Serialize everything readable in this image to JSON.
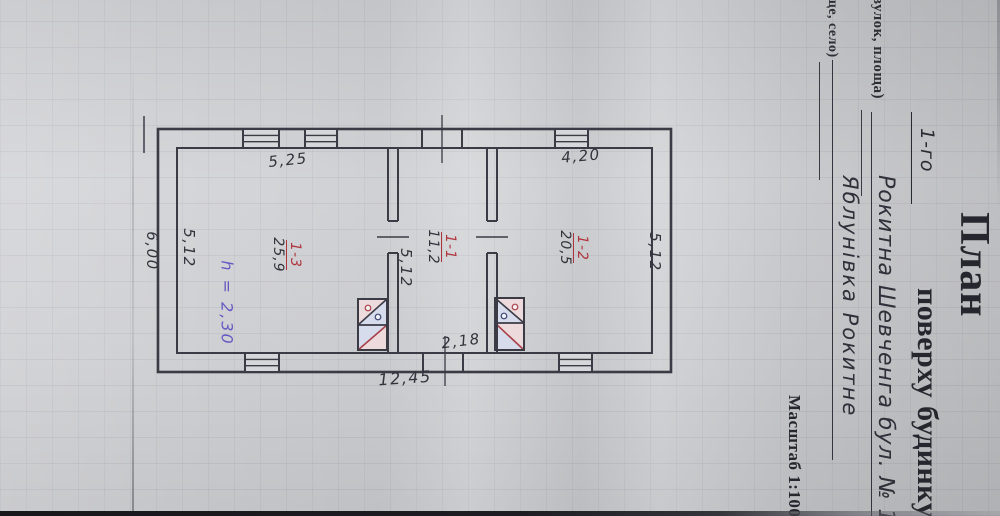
{
  "title_block": {
    "form_title": "План",
    "floor_value": "1-го",
    "form_title_rest": "поверху будинку",
    "street_label_fragment": "вулок, площа)",
    "street_value": "Рокитна Шевченга бул. № 11",
    "settlement_label_fragment": "ще, село)",
    "settlement_value": "Яблунівка Рокитне",
    "scale_label": "Масштаб 1:100"
  },
  "plan": {
    "dimensions": {
      "top_left_room": "5,25",
      "top_right_room": "4,20",
      "left_outer": "6,00",
      "left_room_side": "5,12",
      "vestibule_side": "5,12",
      "right_room_side": "5,12",
      "vestibule_width": "2,18",
      "total_width": "12,45"
    },
    "rooms": [
      {
        "number": "1-3",
        "area": "25,9"
      },
      {
        "number": "1-1",
        "area": "11,2"
      },
      {
        "number": "1-2",
        "area": "20,5"
      }
    ],
    "height_note": "h = 2,30",
    "colors": {
      "ink": "#3b3b45",
      "red": "#b0343c",
      "purple": "#6459c2",
      "stove_pink": "#eddadc",
      "stove_blue": "#d7dcec"
    }
  }
}
